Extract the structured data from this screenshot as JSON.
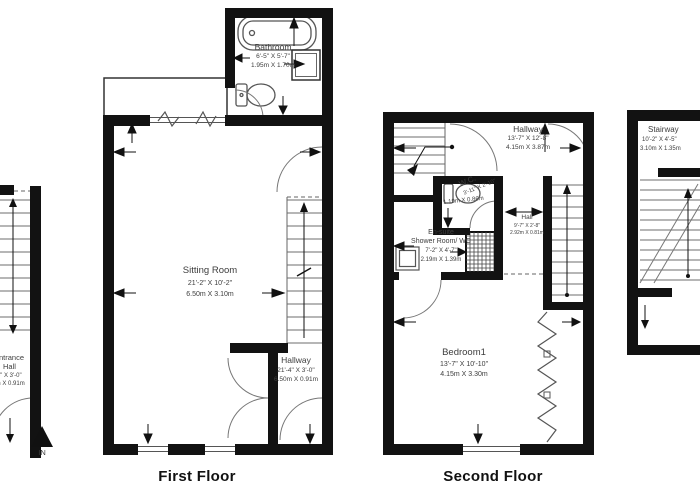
{
  "colors": {
    "background": "#ffffff",
    "walls": "#121212",
    "thin_lines": "#666666",
    "stair_treads": "#8a8a8a",
    "fixtures": "#555555",
    "label_text": "#3d3d3d",
    "title_text": "#111111"
  },
  "titles": {
    "first_floor": "First Floor",
    "second_floor": "Second Floor"
  },
  "ground_floor_partial": {
    "entrance_hall": {
      "name_line1": "Entrance",
      "name_line2": "Hall",
      "dims_ft": "21'-4\" X 3'-0\"",
      "dims_m": "6.50m X 0.91m"
    },
    "entry_marker": "IN"
  },
  "first_floor": {
    "bathroom": {
      "name": "Bathroom",
      "dims_ft": "6'-5\" X 5'-7\"",
      "dims_m": "1.95m X 1.70m"
    },
    "sitting_room": {
      "name": "Sitting Room",
      "dims_ft": "21'-2\" X 10'-2\"",
      "dims_m": "6.50m X 3.10m"
    },
    "hallway": {
      "name": "Hallway",
      "dims_ft": "21'-4\" X 3'-0\"",
      "dims_m": "6.50m X 0.91m"
    }
  },
  "second_floor": {
    "hallway": {
      "name": "Hallway",
      "dims_ft": "13'-7\" X 12'-8\"",
      "dims_m": "4.15m X 3.87m"
    },
    "wc": {
      "name": "W.C.",
      "dims_ft": "3'-11\" X 2'-10\"",
      "dims_m": "1.19m X 0.86m"
    },
    "hall": {
      "name": "Hall",
      "dims_ft": "9'-7\" X 2'-8\"",
      "dims_m": "2.92m X 0.81m"
    },
    "en_suite": {
      "name_line1": "En-suite",
      "name_line2": "Shower Room/ WC",
      "dims_ft": "7'-2\" X 4'-7\"",
      "dims_m": "2.19m X 1.39m"
    },
    "bedroom1": {
      "name": "Bedroom1",
      "dims_ft": "13'-7\" X 10'-10\"",
      "dims_m": "4.15m X 3.30m"
    }
  },
  "third_floor_partial": {
    "stairway": {
      "name": "Stairway",
      "dims_ft": "10'-2\" X 4'-5\"",
      "dims_m": "3.10m X 1.35m"
    }
  },
  "icons": {
    "entry_in_arrow": "▲",
    "stairs_up_arrow": "▲",
    "down_arrow": "▼",
    "left_arrow": "◄",
    "right_arrow": "►"
  }
}
